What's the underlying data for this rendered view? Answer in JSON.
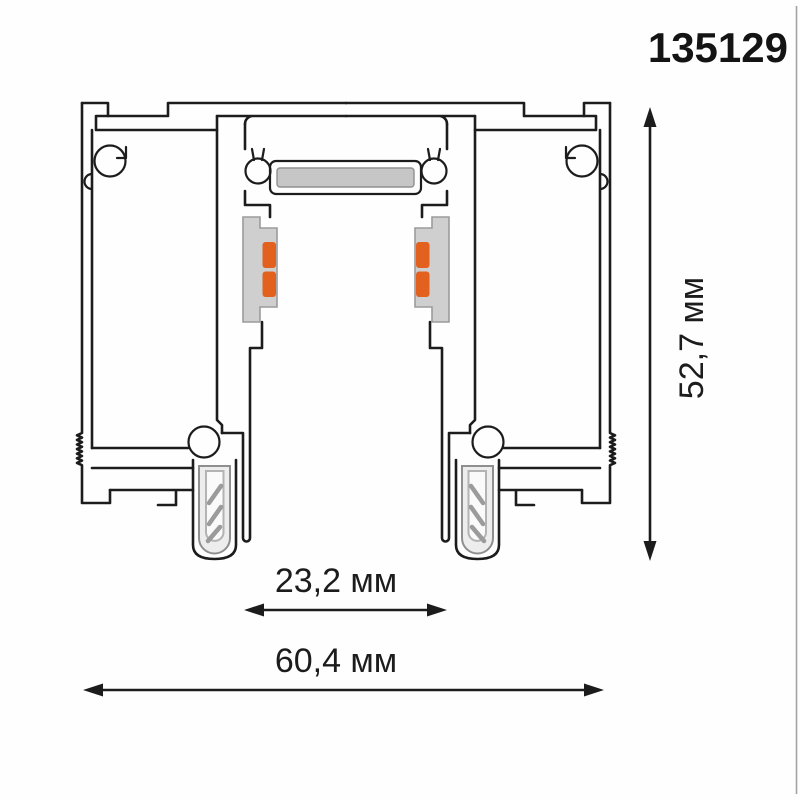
{
  "drawing": {
    "title": "aluminium track profile cross-section",
    "part_number": "135129",
    "dimensions": {
      "height_label": "52,7 мм",
      "slot_width_label": "23,2 мм",
      "total_width_label": "60,4 мм"
    },
    "colors": {
      "line": "#1c1c1c",
      "contact_orange": "#e2611e",
      "pad_gray": "#cfcfcf",
      "strip_gray": "#c6c6c6",
      "screw_body": "#ededed",
      "screw_core": "#fafafa"
    }
  }
}
